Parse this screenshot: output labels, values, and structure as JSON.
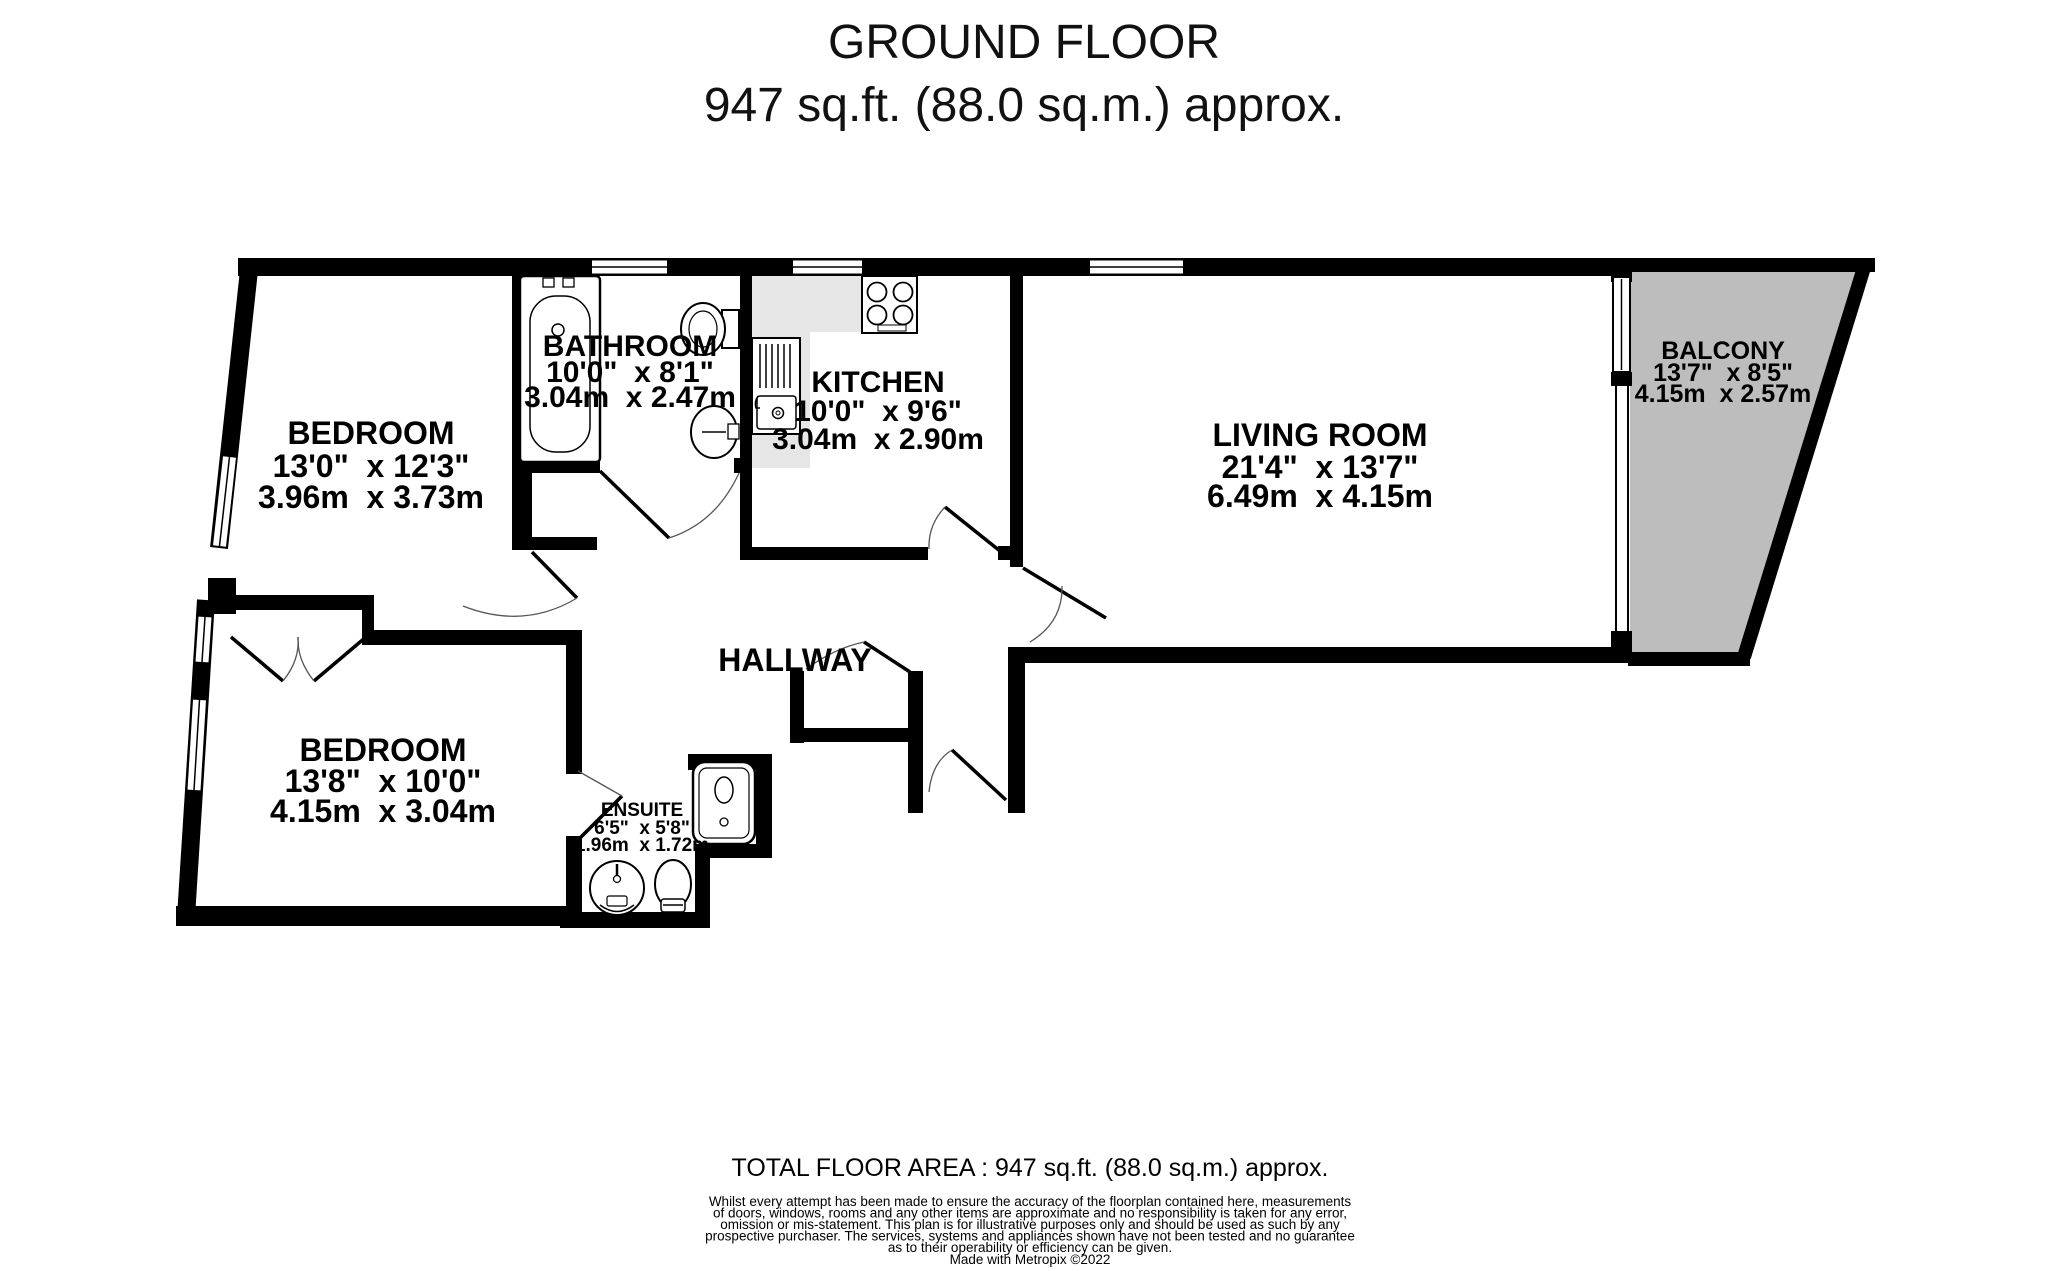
{
  "title": {
    "line1": "GROUND FLOOR",
    "line2": "947 sq.ft. (88.0 sq.m.) approx."
  },
  "rooms": {
    "bedroom_top": {
      "name": "BEDROOM",
      "size_imperial": "13'0\"  x 12'3\"",
      "size_metric": "3.96m  x 3.73m"
    },
    "bathroom": {
      "name": "BATHROOM",
      "size_imperial": "10'0\"  x 8'1\"",
      "size_metric": "3.04m  x 2.47m"
    },
    "kitchen": {
      "name": "KITCHEN",
      "size_imperial": "10'0\"  x 9'6\"",
      "size_metric": "3.04m  x 2.90m"
    },
    "living_room": {
      "name": "LIVING ROOM",
      "size_imperial": "21'4\"  x 13'7\"",
      "size_metric": "6.49m  x 4.15m"
    },
    "balcony": {
      "name": "BALCONY",
      "size_imperial": "13'7\"  x 8'5\"",
      "size_metric": "4.15m  x 2.57m"
    },
    "bedroom_bottom": {
      "name": "BEDROOM",
      "size_imperial": "13'8\"  x 10'0\"",
      "size_metric": "4.15m  x 3.04m"
    },
    "ensuite": {
      "name": "ENSUITE",
      "size_imperial": "6'5\"  x 5'8\"",
      "size_metric": "1.96m  x 1.72m"
    },
    "hallway": {
      "name": "HALLWAY"
    }
  },
  "footer": {
    "total_area": "TOTAL FLOOR AREA : 947 sq.ft. (88.0 sq.m.) approx.",
    "disclaimer_lines": [
      "Whilst every attempt has been made to ensure the accuracy of the floorplan contained here, measurements",
      "of doors, windows, rooms and any other items are approximate and no responsibility is taken for any error,",
      "omission or mis-statement. This plan is for illustrative purposes only and should be used as such by any",
      "prospective purchaser. The services, systems and appliances shown have not been tested and no guarantee",
      "as to their operability or efficiency can be given."
    ],
    "credit": "Made with Metropix ©2022"
  },
  "colors": {
    "wall": "#000000",
    "balcony_fill": "#bdbdbd",
    "counter_fill": "#e6e6e6",
    "background": "#ffffff"
  }
}
